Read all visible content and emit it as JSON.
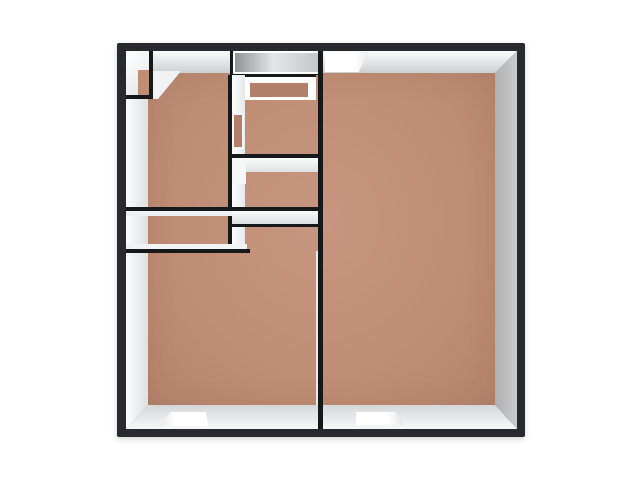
{
  "scene": {
    "kind": "3d-floorplan-render",
    "view": "top-down",
    "background": "#ffffff",
    "colors": {
      "floor": "#bf8d74",
      "floor_light": "#c79680",
      "floor_dark": "#b0806a",
      "frame": "#282a2e",
      "outline": "#17181a",
      "wall_face_light": "#fafbfc",
      "wall_face_mid": "#dcdee0",
      "wall_face_dark": "#aeb0b2",
      "cabinet_light": "#e3e5e7",
      "cabinet_dark": "#919395",
      "window": "#ffffff"
    },
    "rooms": [
      {
        "name": "large-room-right"
      },
      {
        "name": "large-room-bottom-left"
      },
      {
        "name": "hall-top-left"
      },
      {
        "name": "closet-upper-center"
      },
      {
        "name": "closet-lower-center"
      },
      {
        "name": "corner-closet-top-left"
      }
    ],
    "openings": [
      {
        "name": "window-north-wall"
      },
      {
        "name": "window-south-wall-left"
      },
      {
        "name": "window-south-wall-right"
      },
      {
        "name": "door-opening-in-hall-closet-wall"
      }
    ]
  }
}
